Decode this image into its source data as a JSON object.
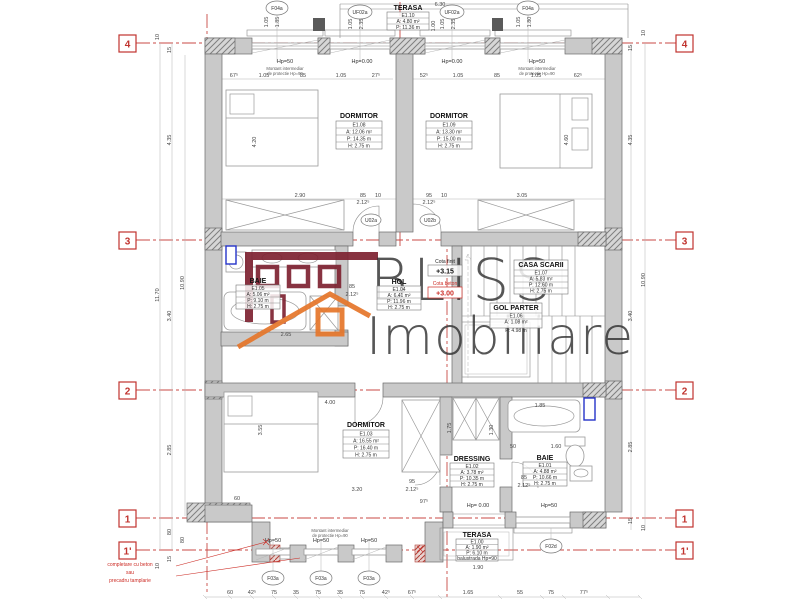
{
  "watermark": {
    "line1": "BLISS",
    "line2": "Imobiliare"
  },
  "grid": {
    "g4": "4",
    "g3": "3",
    "g2": "2",
    "g1": "1",
    "g1p": "1'"
  },
  "rooms": {
    "dormitor_nw": {
      "name": "DORMITOR",
      "code": "E1.08",
      "area": "A: 12.06 m²",
      "perimeter": "P: 14.35 m",
      "height": "H: 2.75 m"
    },
    "dormitor_ne": {
      "name": "DORMITOR",
      "code": "E1.09",
      "area": "A: 13.30 m²",
      "perimeter": "P: 15.00 m",
      "height": "H: 2.75 m"
    },
    "dormitor_s": {
      "name": "DORMITOR",
      "code": "E1.03",
      "area": "A: 16.55 m²",
      "perimeter": "P: 16.40 m",
      "height": "H: 2.75 m"
    },
    "baie_mid": {
      "name": "BAIE",
      "code": "E1.05",
      "area": "A: 5.06 m²",
      "perimeter": "P: 9.10 m",
      "height": "H: 2.75 m"
    },
    "hol": {
      "name": "HOL",
      "code": "E1.04",
      "area": "A: 6.41 m²",
      "perimeter": "P: 11.96 m",
      "height": "H: 2.75 m"
    },
    "casa_scarii": {
      "name": "CASA SCARII",
      "code": "E1.07",
      "area": "A: 5.83 m²",
      "perimeter": "P: 12.60 m",
      "height": "H: 2.75 m"
    },
    "gol_parter": {
      "name": "GOL PARTER",
      "code": "E1.06",
      "area": "A: 1.08 m²",
      "perimeter": "P: 4.98 m"
    },
    "dressing": {
      "name": "DRESSING",
      "code": "E1.02",
      "area": "A: 3.78 m²",
      "perimeter": "P: 10.35 m",
      "height": "H: 2.75 m"
    },
    "baie_se": {
      "name": "BAIE",
      "code": "E1.01",
      "area": "A: 4.88 m²",
      "perimeter": "P: 10.66 m",
      "height": "H: 2.75 m"
    },
    "terasa_n": {
      "name": "TERASA",
      "code": "E1.10",
      "area": "A: 4.80 m²",
      "perimeter": "P: 11.36 m"
    },
    "terasa_s": {
      "name": "TERASA",
      "code": "E1.00",
      "area": "A: 1.90 m²",
      "perimeter": "P: 6.10 m",
      "note": "balustrada Hp=90"
    }
  },
  "tags": {
    "f04a": "F04a",
    "uf02a": "UF02a",
    "f03a": "F03a",
    "f02d": "F02d",
    "u02a": "U02a",
    "u02b": "U02b"
  },
  "hp": {
    "h50": "Hp=50",
    "h000": "Hp=0.00",
    "h000b": "Hp= 0.00"
  },
  "levels": {
    "finit_label": "Cota finit",
    "finit": "+3.15",
    "beton_label": "Cota beton",
    "beton": "+3.00"
  },
  "notes": {
    "montant1": "Montant intermediar",
    "montant2": "de protectie Hp=90",
    "completare_l1": "completare cu beton",
    "completare_l2": "sau",
    "completare_l3": "precadru tamplarie"
  },
  "dims": {
    "top_left": [
      "67⁵",
      "1.05",
      "85",
      "1.05",
      "27⁵"
    ],
    "top_right": [
      "52⁵",
      "1.05",
      "85",
      "1.05",
      "62⁵"
    ],
    "win_pairs": [
      "1.05",
      "1.85",
      "1.05",
      "2.35",
      "1.05",
      "2.35",
      "1.05",
      "1.80"
    ],
    "top_misc": [
      "6.30",
      "1.00"
    ],
    "mid": [
      "2.90",
      "85",
      "10",
      "2.12⁵",
      "95",
      "10",
      "2.12⁵",
      "3.05"
    ],
    "left": [
      "10",
      "15",
      "4.35",
      "10.90",
      "11.70",
      "3.40",
      "2.85",
      "80",
      "80",
      "15",
      "10"
    ],
    "right": [
      "10",
      "15",
      "4.35",
      "10.90",
      "3.40",
      "2.85",
      "15",
      "10"
    ],
    "bottom": [
      "60",
      "42⁵",
      "75",
      "35",
      "75",
      "35",
      "75",
      "42⁵",
      "67⁵",
      "1.65",
      "55",
      "75",
      "77⁵"
    ],
    "interior": [
      "4.20",
      "4.60",
      "3.55",
      "4.00",
      "3.20",
      "60",
      "97⁵",
      "2.65",
      "1.85",
      "50",
      "1.60",
      "1.75",
      "1.30",
      "1.90",
      "95",
      "2.12⁵",
      "85",
      "2.12⁵",
      "85",
      "2.12⁵"
    ]
  },
  "colors": {
    "axis_red": "#c94a45",
    "logo_maroon": "#7e2231",
    "logo_orange": "#e6762a",
    "radiator_blue": "#2533c9",
    "wall_gray": "#c9c9c9"
  }
}
